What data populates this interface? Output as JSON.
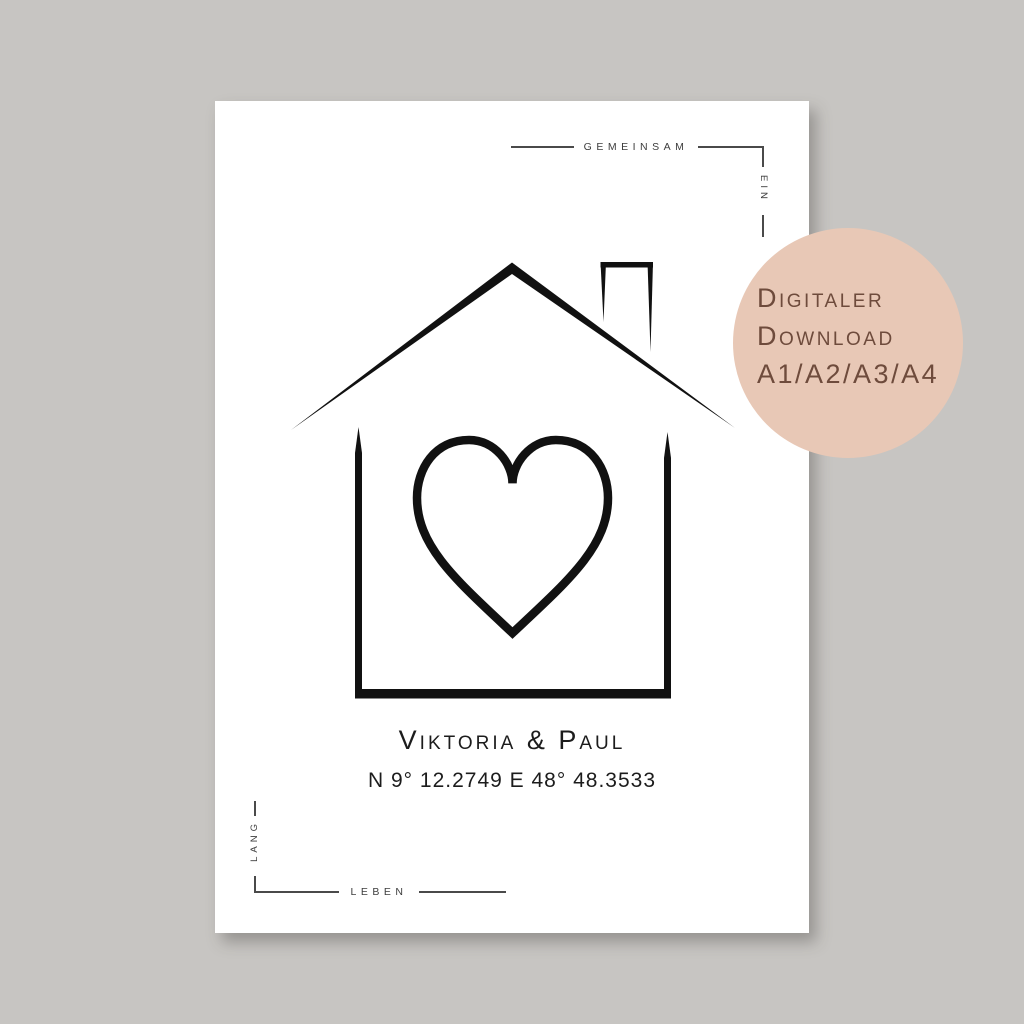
{
  "page": {
    "description": "Product image of a minimalist printable poster: black line-art house with heart, couple names and GPS coordinates, German corner typography, on gray background with digital-download badge"
  },
  "poster": {
    "corner_top_right": {
      "word": "GEMEINSAM",
      "vertical_word": "EIN"
    },
    "corner_bottom_left": {
      "vertical_word": "LANG",
      "word": "LEBEN"
    },
    "names": "Viktoria & Paul",
    "coordinates": "N 9° 12.2749 E 48° 48.3533",
    "artwork": "house-outline-with-heart"
  },
  "badge": {
    "line1": "Digitaler",
    "line2": "Download",
    "line3": "A1/A2/A3/A4"
  },
  "colors": {
    "background": "#c7c5c2",
    "poster": "#ffffff",
    "ink": "#111111",
    "ornament": "#4a4a4a",
    "badge_bg": "#e8c8b6",
    "badge_text": "#6e4b3c"
  }
}
